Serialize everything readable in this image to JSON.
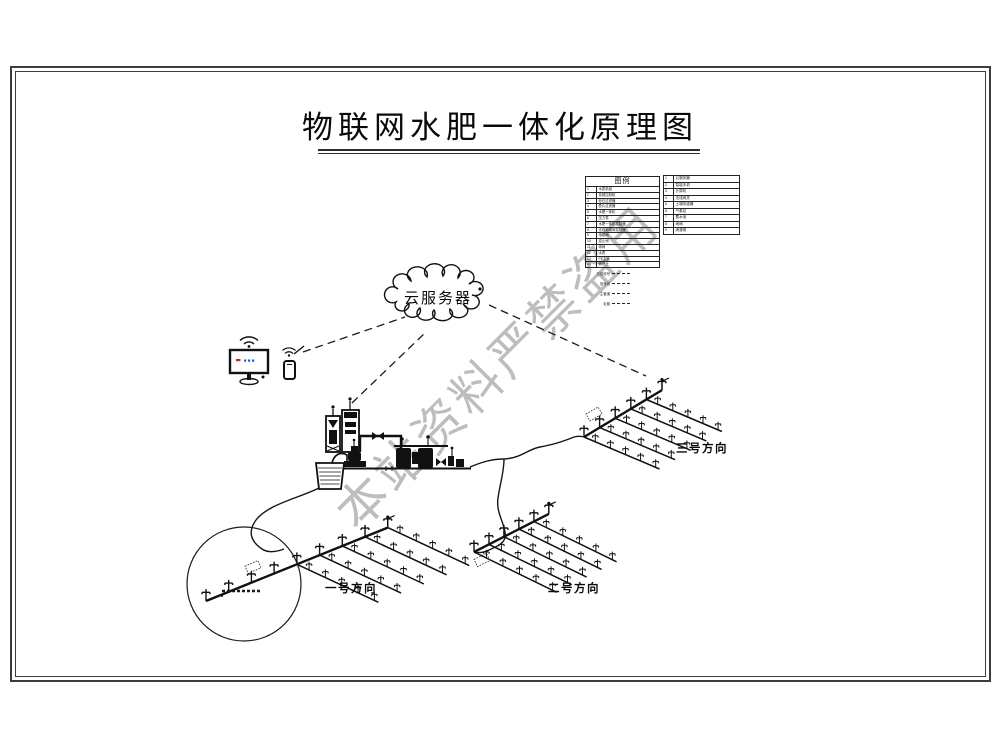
{
  "title": "物联网水肥一体化原理图",
  "watermark": "本站资料严禁盗用",
  "cloud": {
    "label": "云服务器"
  },
  "fields": [
    {
      "label": "一号方向"
    },
    {
      "label": "二号方向"
    },
    {
      "label": "三号方向"
    }
  ],
  "legend": {
    "header": "图例",
    "left_rows": [
      {
        "no": "1",
        "name": "水泵机组"
      },
      {
        "no": "2",
        "name": "变频控制柜"
      },
      {
        "no": "3",
        "name": "砂石过滤器"
      },
      {
        "no": "4",
        "name": "叠片过滤器"
      },
      {
        "no": "5",
        "name": "水肥一体机"
      },
      {
        "no": "6",
        "name": "压力表"
      },
      {
        "no": "7",
        "name": "水肥一体机控制器"
      },
      {
        "no": "8",
        "name": "无线电磁阀控制器"
      },
      {
        "no": "9",
        "name": "电磁阀"
      },
      {
        "no": "10",
        "name": "逆止阀"
      },
      {
        "no": "11",
        "name": "球阀"
      },
      {
        "no": "12",
        "name": "水表"
      },
      {
        "no": "13",
        "name": "PE主管"
      },
      {
        "no": "14",
        "name": "微喷头"
      }
    ],
    "right_rows": [
      {
        "no": "1",
        "name": "云服务器"
      },
      {
        "no": "2",
        "name": "智能手机"
      },
      {
        "no": "3",
        "name": "计算机"
      },
      {
        "no": "4",
        "name": "无线网关"
      },
      {
        "no": "5",
        "name": "土壤传感器"
      },
      {
        "no": "6",
        "name": "气象站"
      },
      {
        "no": "7",
        "name": "蓄水池"
      },
      {
        "no": "8",
        "name": "闸阀"
      },
      {
        "no": "9",
        "name": "滴灌带"
      }
    ],
    "line_types": [
      {
        "label": "无线信号"
      },
      {
        "label": "信号线"
      },
      {
        "label": "主管道"
      },
      {
        "label": "毛管"
      }
    ]
  },
  "icons": {
    "cloud-icon": "scalloped cloud outline",
    "wifi-icon": "wifi arcs with dot",
    "monitor-icon": "desktop monitor with stand",
    "smartphone-icon": "smartphone with stylus",
    "antenna-icon": "antenna mast with dot",
    "water-tank-icon": "hatched open water tank",
    "pump-icon": "pump unit silhouette",
    "filter-station-icon": "twin filter tanks with gauges",
    "fertilizer-machine-icon": "fertilizer injection device",
    "controller-cabinet-icon": "control cabinet with antenna",
    "valve-icon": "bowtie valve",
    "pressure-gauge-icon": "gauge on stem",
    "sprinkler-icon": "micro sprinkler riser",
    "detail-circle-icon": "enlarged detail callout circle"
  },
  "colors": {
    "line": "#111111",
    "watermark": "#bdbdbd",
    "screen_red": "#cc2222",
    "screen_blue": "#2255cc"
  }
}
